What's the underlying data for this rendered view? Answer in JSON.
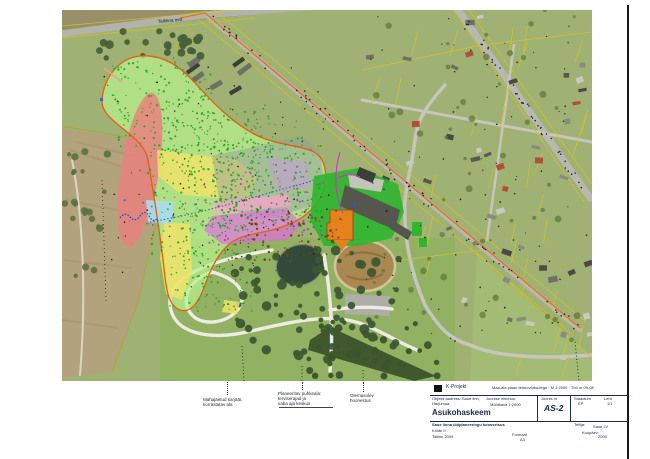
{
  "sheet": {
    "frame_color": "#1a1a1a"
  },
  "map": {
    "road_label": "Tallinna mnt",
    "colors": {
      "zone_green": "#b7f18e",
      "zone_red": "#e8837d",
      "zone_yellow": "#f2e268",
      "zone_blue": "#aadcf2",
      "zone_grey": "#97a09e",
      "zone_magenta": "#e268e2",
      "zone_pink": "#f2a8c8",
      "zone_violet": "#c89ae0",
      "outline_orange": "#e85c10",
      "utility_orange": "#e0761a",
      "facility_green": "#2fb52f",
      "building_orange": "#e5821e",
      "cadastral_yellow": "#d2c226",
      "stream_blue": "#2f55c8"
    },
    "scatter": [
      {
        "layer": "dots-layer",
        "type": "dots",
        "color": "#27a527",
        "count": 160,
        "seed": 11,
        "region": [
          50,
          52,
          100,
          90
        ],
        "r": [
          0.6,
          1.2
        ],
        "opacity": 0.95
      },
      {
        "layer": "dots-layer",
        "type": "dots",
        "color": "#27a527",
        "count": 200,
        "seed": 12,
        "region": [
          85,
          135,
          110,
          115
        ],
        "r": [
          0.6,
          1.2
        ],
        "opacity": 0.95
      },
      {
        "layer": "dots-layer",
        "type": "dots",
        "color": "#27a527",
        "count": 210,
        "seed": 13,
        "region": [
          150,
          128,
          110,
          95
        ],
        "r": [
          0.6,
          1.2
        ],
        "opacity": 0.95
      },
      {
        "layer": "dots-layer",
        "type": "dots",
        "color": "#27a527",
        "count": 85,
        "seed": 14,
        "region": [
          108,
          240,
          82,
          62
        ],
        "r": [
          0.6,
          1.1
        ],
        "opacity": 0.95
      },
      {
        "layer": "dots-layer",
        "type": "dots",
        "color": "#27a527",
        "count": 80,
        "seed": 15,
        "region": [
          128,
          98,
          84,
          52
        ],
        "r": [
          0.6,
          1.1
        ],
        "opacity": 0.95
      },
      {
        "layer": "dots-layer",
        "type": "dots",
        "color": "#111111",
        "count": 90,
        "seed": 21,
        "region": [
          40,
          45,
          230,
          250
        ],
        "r": [
          0.5,
          0.9
        ],
        "opacity": 0.9
      },
      {
        "layer": "dots-layer",
        "type": "dots",
        "color": "#d022d0",
        "count": 55,
        "seed": 31,
        "region": [
          138,
          160,
          125,
          78
        ],
        "r": [
          0.6,
          1.1
        ],
        "opacity": 0.9
      },
      {
        "layer": "dots-layer",
        "type": "dots",
        "color": "#6e4418",
        "count": 90,
        "seed": 41,
        "region": [
          170,
          200,
          110,
          52
        ],
        "r": [
          0.7,
          1.4
        ],
        "opacity": 0.95
      },
      {
        "layer": "dots-layer",
        "type": "dots",
        "color": "#6d7a1f",
        "count": 55,
        "seed": 51,
        "region": [
          95,
          95,
          170,
          130
        ],
        "r": [
          0.5,
          1.0
        ],
        "opacity": 0.85
      },
      {
        "layer": "dots-layer",
        "type": "dots",
        "color": "#2244cc",
        "count": 22,
        "seed": 61,
        "region": [
          60,
          185,
          200,
          36
        ],
        "r": [
          0.5,
          0.9
        ],
        "opacity": 0.9
      },
      {
        "layer": "dots-layer",
        "type": "dots",
        "color": "#161616",
        "count": 100,
        "seed": 71,
        "region": [
          300,
          5,
          228,
          330
        ],
        "r": [
          0.5,
          0.9
        ],
        "opacity": 0.85
      },
      {
        "layer": "dots-layer",
        "type": "dotline",
        "color": "#141414",
        "count": 70,
        "seed": 81,
        "from": [
          143,
          2
        ],
        "to": [
          518,
          320
        ],
        "jitter": 4,
        "r": 0.8,
        "opacity": 0.9
      },
      {
        "layer": "dots-layer",
        "type": "dotline",
        "color": "#141414",
        "count": 40,
        "seed": 82,
        "from": [
          392,
          -4
        ],
        "to": [
          528,
          188
        ],
        "jitter": 4,
        "r": 0.8,
        "opacity": 0.9
      },
      {
        "layer": "houses-layer",
        "type": "rects",
        "count": 26,
        "seed": 91,
        "region": [
          300,
          5,
          222,
          172
        ],
        "w": [
          5,
          10
        ],
        "h": [
          3,
          6
        ],
        "rot": [
          -25,
          25
        ],
        "colors": [
          "#8a8a84",
          "#6f6f68",
          "#585850",
          "#c9c9c2",
          "#4a4a44",
          "#b05038"
        ]
      },
      {
        "layer": "houses-layer",
        "type": "rects",
        "count": 13,
        "seed": 92,
        "region": [
          360,
          185,
          162,
          128
        ],
        "w": [
          5,
          10
        ],
        "h": [
          3,
          6
        ],
        "rot": [
          -25,
          25
        ],
        "colors": [
          "#8a8a84",
          "#6f6f68",
          "#c9c9c2",
          "#4a4a44",
          "#b05038"
        ]
      },
      {
        "layer": "houses-layer",
        "type": "rects",
        "count": 5,
        "seed": 93,
        "region": [
          460,
          300,
          68,
          55
        ],
        "w": [
          5,
          9
        ],
        "h": [
          3,
          6
        ],
        "rot": [
          -25,
          25
        ],
        "colors": [
          "#8a8a84",
          "#c9c9c2",
          "#585850"
        ]
      },
      {
        "layer": "houses-layer",
        "type": "rects",
        "count": 7,
        "seed": 94,
        "region": [
          80,
          48,
          100,
          55
        ],
        "w": [
          12,
          17
        ],
        "h": [
          4,
          6
        ],
        "rot": [
          -38,
          -30
        ],
        "colors": [
          "#55564e",
          "#6f6f68",
          "#3c3e38"
        ]
      },
      {
        "layer": "trees-layer",
        "type": "dots",
        "color": "#3d5930",
        "count": 75,
        "seed": 101,
        "region": [
          168,
          240,
          170,
          118
        ],
        "r": [
          2,
          5
        ],
        "opacity": 0.95
      },
      {
        "layer": "trees-layer",
        "type": "dots",
        "color": "#47603a",
        "count": 26,
        "seed": 102,
        "region": [
          30,
          20,
          110,
          28
        ],
        "r": [
          2.5,
          4.5
        ],
        "opacity": 0.95
      },
      {
        "layer": "trees-layer",
        "type": "dots",
        "color": "#5c7040",
        "count": 22,
        "seed": 103,
        "region": [
          0,
          138,
          48,
          135
        ],
        "r": [
          2,
          4
        ],
        "opacity": 0.9
      },
      {
        "layer": "trees-layer",
        "type": "dots",
        "color": "#3c5429",
        "count": 32,
        "seed": 104,
        "region": [
          246,
          312,
          130,
          56
        ],
        "r": [
          2,
          4
        ],
        "opacity": 0.95
      },
      {
        "layer": "trees-layer",
        "type": "dots",
        "color": "#60793c",
        "count": 55,
        "seed": 105,
        "region": [
          300,
          0,
          228,
          338
        ],
        "r": [
          1.5,
          3.5
        ],
        "opacity": 0.75
      },
      {
        "layer": "cadastral-layer",
        "type": "hatch",
        "color": "#d2c226",
        "count": 14,
        "seed": 111,
        "region": [
          298,
          8,
          228,
          120
        ],
        "len": [
          20,
          30
        ],
        "angle": 105,
        "w": 0.8
      },
      {
        "layer": "cadastral-layer",
        "type": "hatch",
        "color": "#d2c226",
        "count": 12,
        "seed": 112,
        "region": [
          335,
          128,
          193,
          125
        ],
        "len": [
          18,
          28
        ],
        "angle": 105,
        "w": 0.8
      },
      {
        "layer": "cadastral-layer",
        "type": "hatch",
        "color": "#d2c226",
        "count": 8,
        "seed": 113,
        "region": [
          415,
          255,
          113,
          95
        ],
        "len": [
          16,
          26
        ],
        "angle": 105,
        "w": 0.8
      },
      {
        "layer": "cadastral-layer",
        "type": "hatch",
        "color": "#c2b628",
        "count": 6,
        "seed": 114,
        "region": [
          60,
          0,
          150,
          35
        ],
        "len": [
          12,
          20
        ],
        "angle": 100,
        "w": 0.7
      }
    ]
  },
  "annotations": {
    "c1": {
      "l1": "Mahajäetud karjäär,",
      "l2": "korrastatav ala"
    },
    "c2": {
      "l1": "Planeeritav puhkeala:",
      "l2": "terviserajad ja",
      "l3": "vaba aja keskus"
    },
    "c3": {
      "l1": "Olemasolev",
      "l2": "hoonestus"
    }
  },
  "titleblock": {
    "company": "K-Projekt",
    "top_right": "Maa-ala plaan tehnovõrkudega · M 1:2000 · Töö nr 09-08",
    "left_small_1": "Objekti aadress: Saue linn,",
    "left_small_2": "Harjumaa",
    "mid_small_1": "Joonise nimetus:",
    "mid_small_2": "Mõõtkava 1:2000",
    "title": "Asukohaskeem",
    "num_label": "Joonis nr",
    "num": "AS-2",
    "right_label_1": "Staadium",
    "right_val_1": "EP",
    "right_label_2": "Leht",
    "right_val_2": "1/1",
    "bottom_line_1": "Saue linna üldplaneeringu koosseisus",
    "bottom_line_2": "Köide II",
    "bottom_line_3": "Tallinn 2009",
    "bottom_center_1": "Formaat",
    "bottom_center_2": "A3",
    "tellija_label": "Tellija:",
    "tellija_val": "Saue LV",
    "kuupaev_label": "Kuupäev:",
    "kuupaev_val": "2009"
  }
}
